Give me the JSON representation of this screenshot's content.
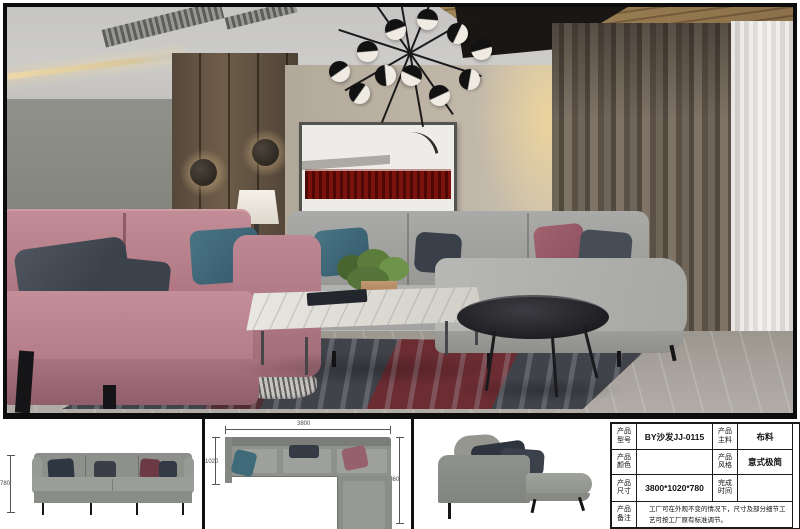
{
  "spec_table": {
    "rows": [
      {
        "label1": "产品型号",
        "value1": "BY沙发JJ-0115",
        "label2": "产品主料",
        "value2": "布料"
      },
      {
        "label1": "产品颜色",
        "value1": "",
        "label2": "产品风格",
        "value2": "意式极简"
      },
      {
        "label1": "产品尺寸",
        "value1": "3800*1020*780",
        "label2": "完成时间",
        "value2": ""
      },
      {
        "label1": "产品备注",
        "remark": "工厂可在外观不变的情况下，尺寸及部分细节工艺可按工厂原有标准调节。"
      }
    ]
  },
  "drawings": {
    "front_view": {
      "height_label": "780"
    },
    "top_view": {
      "width_label": "3800",
      "depth_label": "1020",
      "chaise_label": "1860"
    }
  },
  "colors": {
    "sofa_pink": "#b5808b",
    "sofa_gray": "#a5a5a3",
    "pillow_teal": "#3f6b7a",
    "pillow_rose": "#9c5f6d",
    "art_red": "#7c120c",
    "wood_panel": "#6e5d49",
    "frame_border": "#0d0d0d"
  }
}
